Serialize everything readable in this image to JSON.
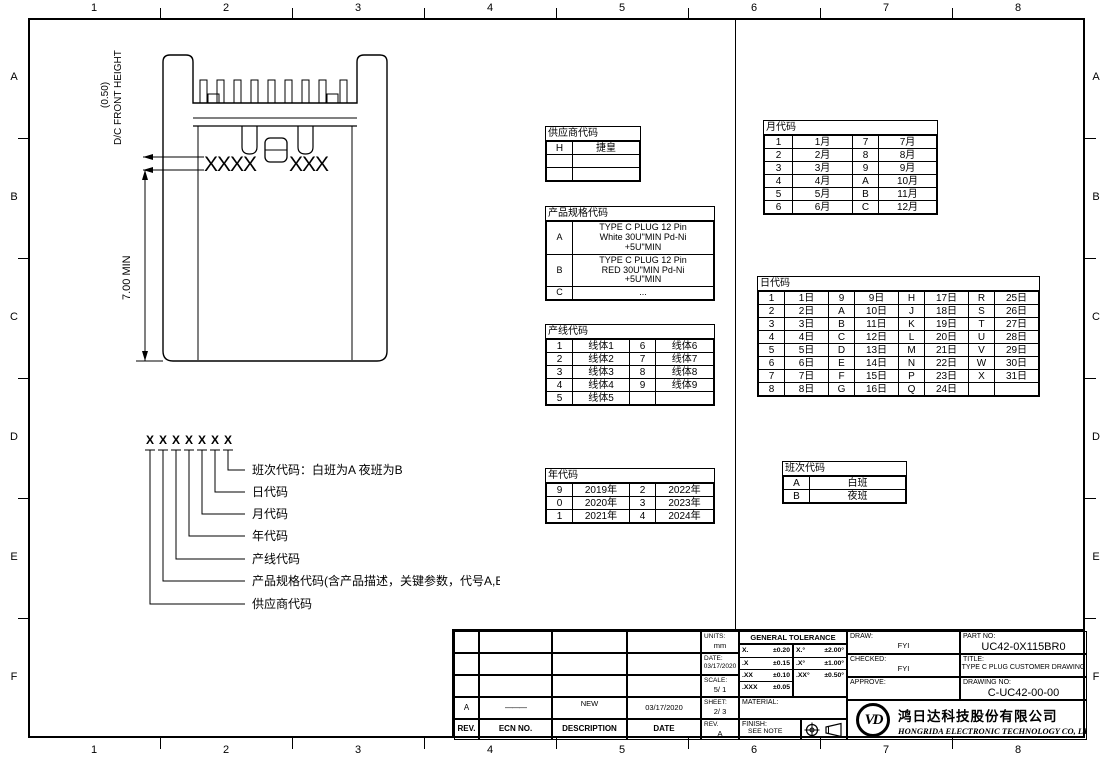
{
  "frame": {
    "cols": [
      "1",
      "2",
      "3",
      "4",
      "5",
      "6",
      "7",
      "8"
    ],
    "rows": [
      "A",
      "B",
      "C",
      "D",
      "E",
      "F"
    ]
  },
  "drawing": {
    "front_height_dim": "(0.50)",
    "front_height_label": "D/C FRONT HEIGHT",
    "body_dim": "7.00 MIN",
    "mark_left": "XXXX",
    "mark_right": "XXX"
  },
  "code_legend": {
    "digits": [
      "X",
      "X",
      "X",
      "X",
      "X",
      "X",
      "X"
    ],
    "labels": [
      "班次代码：白班为A 夜班为B",
      "日代码",
      "月代码",
      "年代码",
      "产线代码",
      "产品规格代码(含产品描述，关键参数，代号A,B,C等)",
      "供应商代码"
    ]
  },
  "tables": {
    "supplier": {
      "title": "供应商代码",
      "rows": [
        [
          "H",
          "捷皇"
        ],
        [
          "",
          ""
        ],
        [
          "",
          ""
        ]
      ]
    },
    "product_spec": {
      "title": "产品规格代码",
      "rows": [
        [
          "A",
          "TYPE C PLUG 12 Pin\nWhite  30U\"MIN Pd-Ni\n+5U\"MIN"
        ],
        [
          "B",
          "TYPE C PLUG 12 Pin\nRED 30U\"MIN Pd-Ni\n+5U\"MIN"
        ],
        [
          "C",
          "..."
        ]
      ]
    },
    "line": {
      "title": "产线代码",
      "rows": [
        [
          "1",
          "线体1",
          "6",
          "线体6"
        ],
        [
          "2",
          "线体2",
          "7",
          "线体7"
        ],
        [
          "3",
          "线体3",
          "8",
          "线体8"
        ],
        [
          "4",
          "线体4",
          "9",
          "线体9"
        ],
        [
          "5",
          "线体5",
          "",
          ""
        ]
      ]
    },
    "year": {
      "title": "年代码",
      "rows": [
        [
          "9",
          "2019年",
          "2",
          "2022年"
        ],
        [
          "0",
          "2020年",
          "3",
          "2023年"
        ],
        [
          "1",
          "2021年",
          "4",
          "2024年"
        ]
      ]
    },
    "month": {
      "title": "月代码",
      "rows": [
        [
          "1",
          "1月",
          "7",
          "7月"
        ],
        [
          "2",
          "2月",
          "8",
          "8月"
        ],
        [
          "3",
          "3月",
          "9",
          "9月"
        ],
        [
          "4",
          "4月",
          "A",
          "10月"
        ],
        [
          "5",
          "5月",
          "B",
          "11月"
        ],
        [
          "6",
          "6月",
          "C",
          "12月"
        ]
      ]
    },
    "day": {
      "title": "日代码",
      "rows": [
        [
          "1",
          "1日",
          "9",
          "9日",
          "H",
          "17日",
          "R",
          "25日"
        ],
        [
          "2",
          "2日",
          "A",
          "10日",
          "J",
          "18日",
          "S",
          "26日"
        ],
        [
          "3",
          "3日",
          "B",
          "11日",
          "K",
          "19日",
          "T",
          "27日"
        ],
        [
          "4",
          "4日",
          "C",
          "12日",
          "L",
          "20日",
          "U",
          "28日"
        ],
        [
          "5",
          "5日",
          "D",
          "13日",
          "M",
          "21日",
          "V",
          "29日"
        ],
        [
          "6",
          "6日",
          "E",
          "14日",
          "N",
          "22日",
          "W",
          "30日"
        ],
        [
          "7",
          "7日",
          "F",
          "15日",
          "P",
          "23日",
          "X",
          "31日"
        ],
        [
          "8",
          "8日",
          "G",
          "16日",
          "Q",
          "24日",
          "",
          ""
        ]
      ]
    },
    "shift": {
      "title": "班次代码",
      "rows": [
        [
          "A",
          "白班"
        ],
        [
          "B",
          "夜班"
        ]
      ]
    }
  },
  "title_block": {
    "revision": {
      "row": [
        "A",
        "———",
        "NEW",
        "03/17/2020"
      ],
      "headers": [
        "REV.",
        "ECN NO.",
        "DESCRIPTION",
        "DATE"
      ]
    },
    "units_label": "UNITS:",
    "units_value": "mm",
    "date_label": "DATE:",
    "date_value": "03/17/2020",
    "scale_label": "SCALE:",
    "scale_value": "5/ 1",
    "sheet_label": "SHEET:",
    "sheet_value": "2/ 3",
    "rev_label": "REV.",
    "rev_value": "A",
    "tolerance": {
      "title": "GENERAL TOLERANCE",
      "linear": [
        [
          "X.",
          "±0.20"
        ],
        [
          ".X",
          "±0.15"
        ],
        [
          ".XX",
          "±0.10"
        ],
        [
          ".XXX",
          "±0.05"
        ]
      ],
      "angular": [
        [
          "X.°",
          "±2.00°"
        ],
        [
          ".X°",
          "±1.00°"
        ],
        [
          ".XX°",
          "±0.50°"
        ]
      ]
    },
    "material_label": "MATERIAL:",
    "finish_label": "FINISH:",
    "finish_value": "SEE NOTE",
    "draw_label": "DRAW:",
    "draw_value": "FYI",
    "checked_label": "CHECKED:",
    "checked_value": "FYI",
    "approve_label": "APPROVE:",
    "approve_value": "",
    "part_label": "PART NO:",
    "part_value": "UC42-0X115BR0",
    "title_label": "TITLE:",
    "title_value": "TYPE C PLUG CUSTOMER DRAWING",
    "drawing_label": "DRAWING NO:",
    "drawing_value": "C-UC42-00-00",
    "logo_text": "VD",
    "company_cn": "鸿日达科技股份有限公司",
    "company_en": "HONGRIDA ELECTRONIC TECHNOLOGY CO, LTD."
  }
}
